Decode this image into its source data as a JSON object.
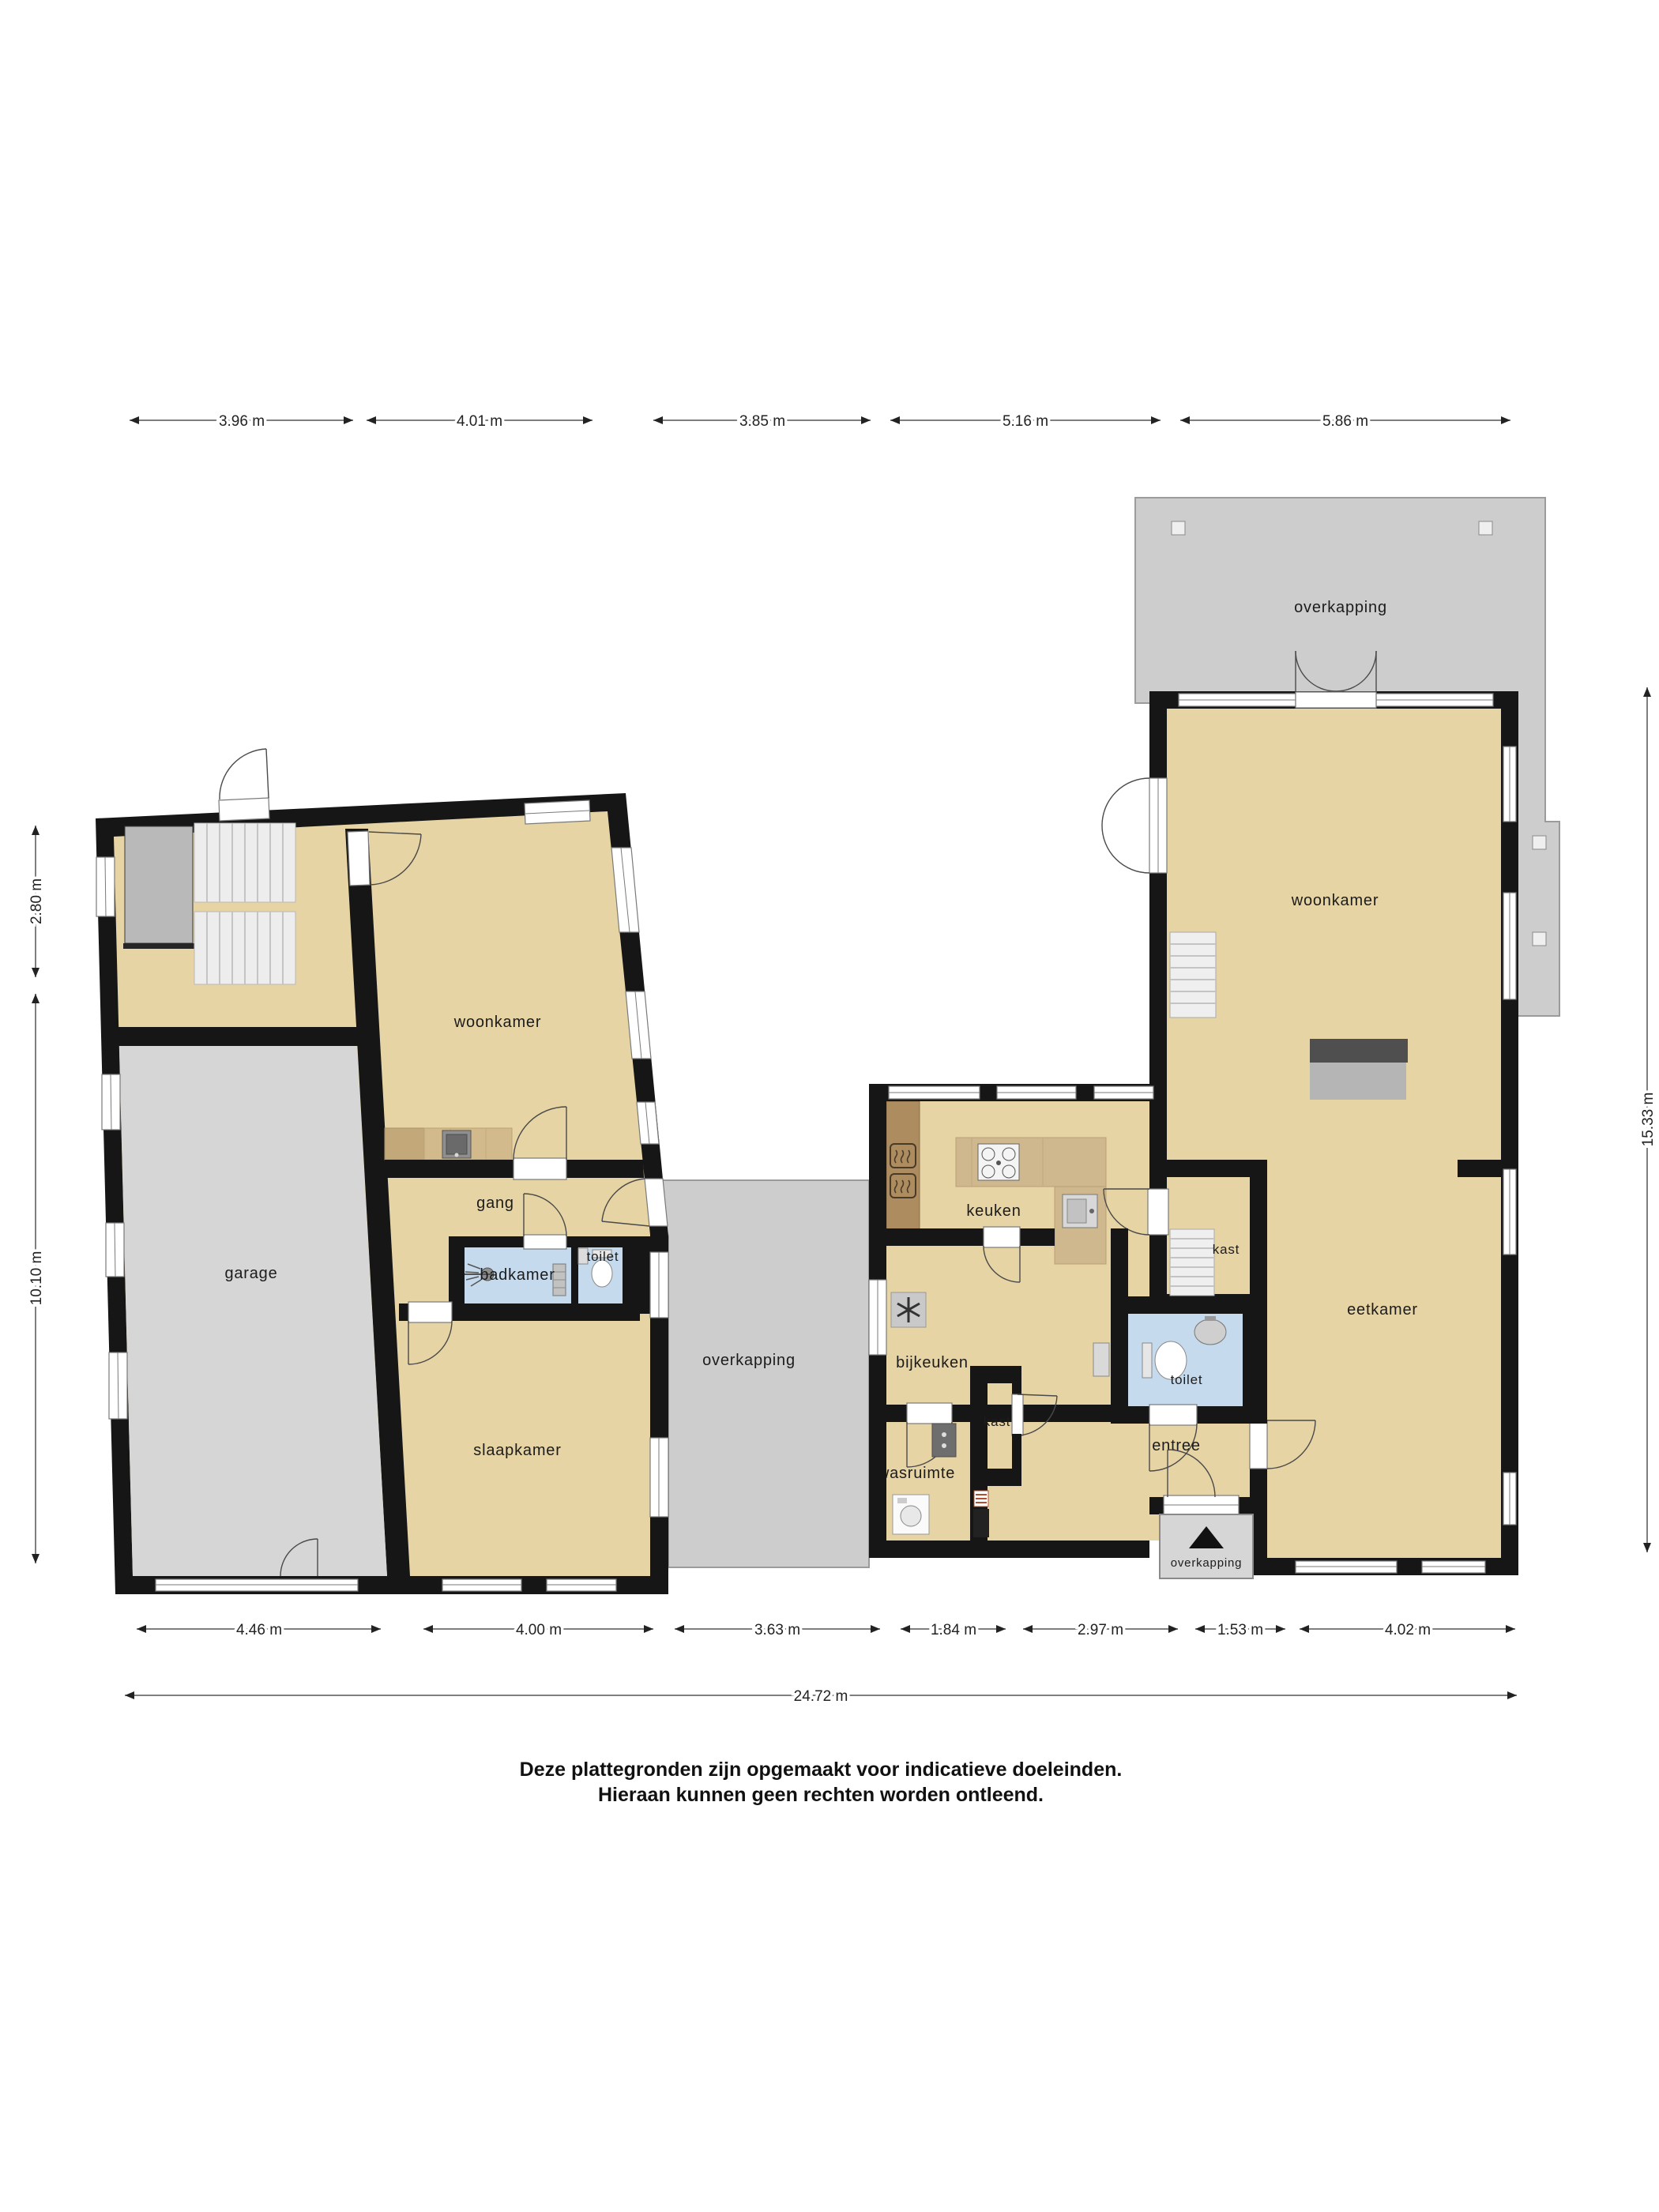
{
  "rooms": {
    "garage": {
      "label": "garage"
    },
    "woonkamer_links": {
      "label": "woonkamer"
    },
    "gang": {
      "label": "gang"
    },
    "badkamer": {
      "label": "badkamer"
    },
    "toilet_links": {
      "label": "toilet"
    },
    "slaapkamer": {
      "label": "slaapkamer"
    },
    "overkapping_mid": {
      "label": "overkapping"
    },
    "overkapping_top": {
      "label": "overkapping"
    },
    "woonkamer_rechts": {
      "label": "woonkamer"
    },
    "keuken": {
      "label": "keuken"
    },
    "kast_boven": {
      "label": "kast"
    },
    "eetkamer": {
      "label": "eetkamer"
    },
    "bijkeuken": {
      "label": "bijkeuken"
    },
    "toilet_rechts": {
      "label": "toilet"
    },
    "kast_onder": {
      "label": "kast"
    },
    "wasruimte": {
      "label": "wasruimte"
    },
    "entree": {
      "label": "entree"
    },
    "overkapping_onder": {
      "label": "overkapping"
    }
  },
  "dimensions": {
    "top": {
      "t1": "3.96 m",
      "t2": "4.01 m",
      "t3": "3.85 m",
      "t4": "5.16 m",
      "t5": "5.86 m"
    },
    "bottom": {
      "b1": "4.46 m",
      "b2": "4.00 m",
      "b3": "3.63 m",
      "b4": "1.84 m",
      "b5": "2.97 m",
      "b6": "1.53 m",
      "b7": "4.02 m"
    },
    "total": {
      "label": "24.72 m"
    },
    "left": {
      "l1": "2.80 m",
      "l2": "10.10 m"
    },
    "right": {
      "r1": "15.33 m"
    }
  },
  "disclaimer": {
    "line1": "Deze plattegronden zijn opgemaakt voor indicatieve doeleinden.",
    "line2": "Hieraan kunnen geen rechten worden ontleend."
  },
  "colors": {
    "floor_tan": "#e7d4a4",
    "wall_black": "#161616",
    "wet_room_blue": "#c6daee",
    "covered_grey": "#cdcdcd",
    "garage_grey": "#d6d6d6",
    "counter_wood": "#cfb88e",
    "cabinet_brown": "#ad8d60"
  }
}
